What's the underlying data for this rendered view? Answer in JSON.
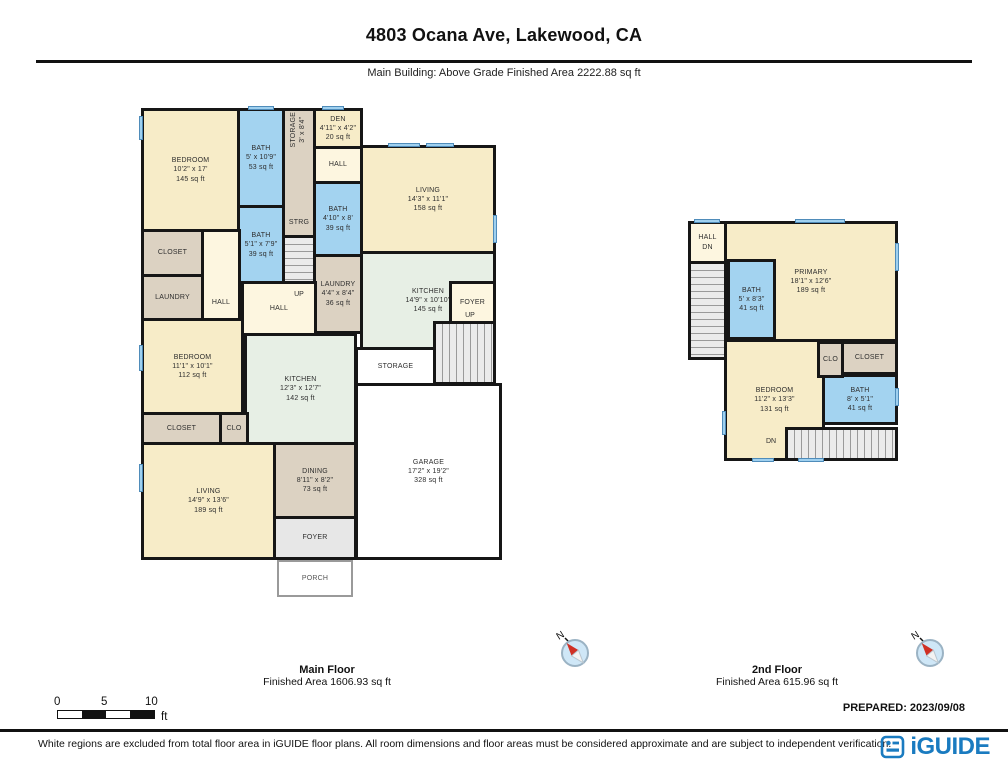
{
  "header": {
    "title": "4803 Ocana Ave, Lakewood, CA",
    "subtitle": "Main Building: Above Grade Finished Area 2222.88 sq ft"
  },
  "floors": {
    "main": {
      "label": "Main Floor",
      "area_label": "Finished Area 1606.93 sq ft",
      "rooms": {
        "bedroom_tl": {
          "name": "BEDROOM",
          "dims": "10'2\" x 17'",
          "area": "145 sq ft"
        },
        "bath_tl": {
          "name": "BATH",
          "dims": "5' x 10'9\"",
          "area": "53 sq ft"
        },
        "storage_tall": {
          "name": "STORAGE",
          "dims": "3' x 8'4\""
        },
        "strg": {
          "name": "STRG"
        },
        "den": {
          "name": "DEN",
          "dims": "4'11\" x 4'2\"",
          "area": "20 sq ft"
        },
        "hall_top": {
          "name": "HALL"
        },
        "bath_mid": {
          "name": "BATH",
          "dims": "4'10\" x 8'",
          "area": "39 sq ft"
        },
        "laundry_mid": {
          "name": "LAUNDRY",
          "dims": "4'4\" x 8'4\"",
          "area": "36 sq ft"
        },
        "living_tr": {
          "name": "LIVING",
          "dims": "14'3\" x 11'1\"",
          "area": "158 sq ft"
        },
        "bath_left": {
          "name": "BATH",
          "dims": "5'1\" x 7'9\"",
          "area": "39 sq ft"
        },
        "closet_tl": {
          "name": "CLOSET"
        },
        "laundry_left": {
          "name": "LAUNDRY"
        },
        "hall_left": {
          "name": "HALL"
        },
        "hall_center": {
          "name": "HALL"
        },
        "up_center": {
          "name": "UP"
        },
        "kitchen_right": {
          "name": "KITCHEN",
          "dims": "14'9\" x 10'10\"",
          "area": "145 sq ft"
        },
        "foyer_right": {
          "name": "FOYER"
        },
        "up_right": {
          "name": "UP"
        },
        "storage_center": {
          "name": "STORAGE"
        },
        "bedroom_ml": {
          "name": "BEDROOM",
          "dims": "11'1\" x 10'1\"",
          "area": "112 sq ft"
        },
        "kitchen_center": {
          "name": "KITCHEN",
          "dims": "12'3\" x 12'7\"",
          "area": "142 sq ft"
        },
        "closet_bl": {
          "name": "CLOSET"
        },
        "clo_bl": {
          "name": "CLO"
        },
        "living_bl": {
          "name": "LIVING",
          "dims": "14'9\" x 13'6\"",
          "area": "189 sq ft"
        },
        "dining": {
          "name": "DINING",
          "dims": "8'11\" x 8'2\"",
          "area": "73 sq ft"
        },
        "garage": {
          "name": "GARAGE",
          "dims": "17'2\" x 19'2\"",
          "area": "328 sq ft"
        },
        "foyer_bottom": {
          "name": "FOYER"
        },
        "porch": {
          "name": "PORCH"
        }
      }
    },
    "second": {
      "label": "2nd Floor",
      "area_label": "Finished Area 615.96 sq ft",
      "rooms": {
        "hall": {
          "name": "HALL"
        },
        "dn_top": {
          "name": "DN"
        },
        "primary": {
          "name": "PRIMARY",
          "dims": "18'1\" x 12'6\"",
          "area": "189 sq ft"
        },
        "bath_primary": {
          "name": "BATH",
          "dims": "5' x 8'3\"",
          "area": "41 sq ft"
        },
        "bedroom": {
          "name": "BEDROOM",
          "dims": "11'2\" x 13'3\"",
          "area": "131 sq ft"
        },
        "clo": {
          "name": "CLO"
        },
        "closet": {
          "name": "CLOSET"
        },
        "bath2": {
          "name": "BATH",
          "dims": "8' x 5'1\"",
          "area": "41 sq ft"
        },
        "dn_bottom": {
          "name": "DN"
        }
      }
    }
  },
  "scale": {
    "zero": "0",
    "five": "5",
    "ten": "10",
    "unit": "ft"
  },
  "compass": {
    "label": "N"
  },
  "prepared": "PREPARED: 2023/09/08",
  "footer": {
    "disclaimer": "White regions are excluded from total floor area in iGUIDE floor plans. All room dimensions and floor areas must be considered approximate and are subject to independent verification.",
    "brand": "iGUIDE"
  },
  "colors": {
    "wall": "#161616",
    "room_cream": "#f7ecc8",
    "bath_blue": "#a3d3f0",
    "closet_tan": "#dcd2c2",
    "kitchen_green": "#e7efe5",
    "brand_blue": "#1a7bc0",
    "compass_red": "#d03024",
    "window_blue": "#9fd0ef"
  }
}
